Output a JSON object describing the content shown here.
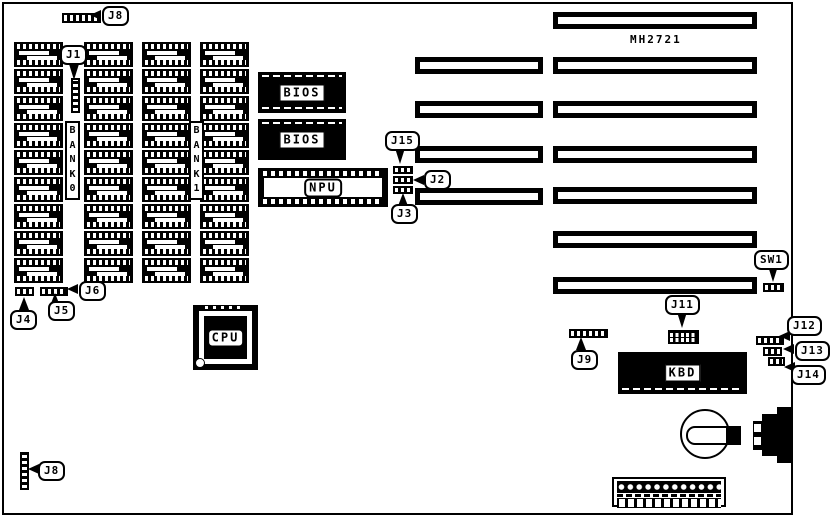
{
  "part_number": "MH2721",
  "chips": {
    "bios_top": "BIOS",
    "bios_bottom": "BIOS",
    "npu": "NPU",
    "cpu": "CPU",
    "kbd": "KBD"
  },
  "memory": {
    "bank0": "BANK0",
    "bank1": "BANK1",
    "sockets_per_bank_column": 9,
    "columns": 4
  },
  "connectors": {
    "j8_top": "J8",
    "j1": "J1",
    "j15": "J15",
    "j2": "J2",
    "j3": "J3",
    "j4": "J4",
    "j5": "J5",
    "j6": "J6",
    "j9": "J9",
    "j11": "J11",
    "sw1": "SW1",
    "j12": "J12",
    "j13": "J13",
    "j14": "J14",
    "j8_bottom": "J8"
  },
  "colors": {
    "ink": "#000000",
    "paper": "#ffffff"
  }
}
